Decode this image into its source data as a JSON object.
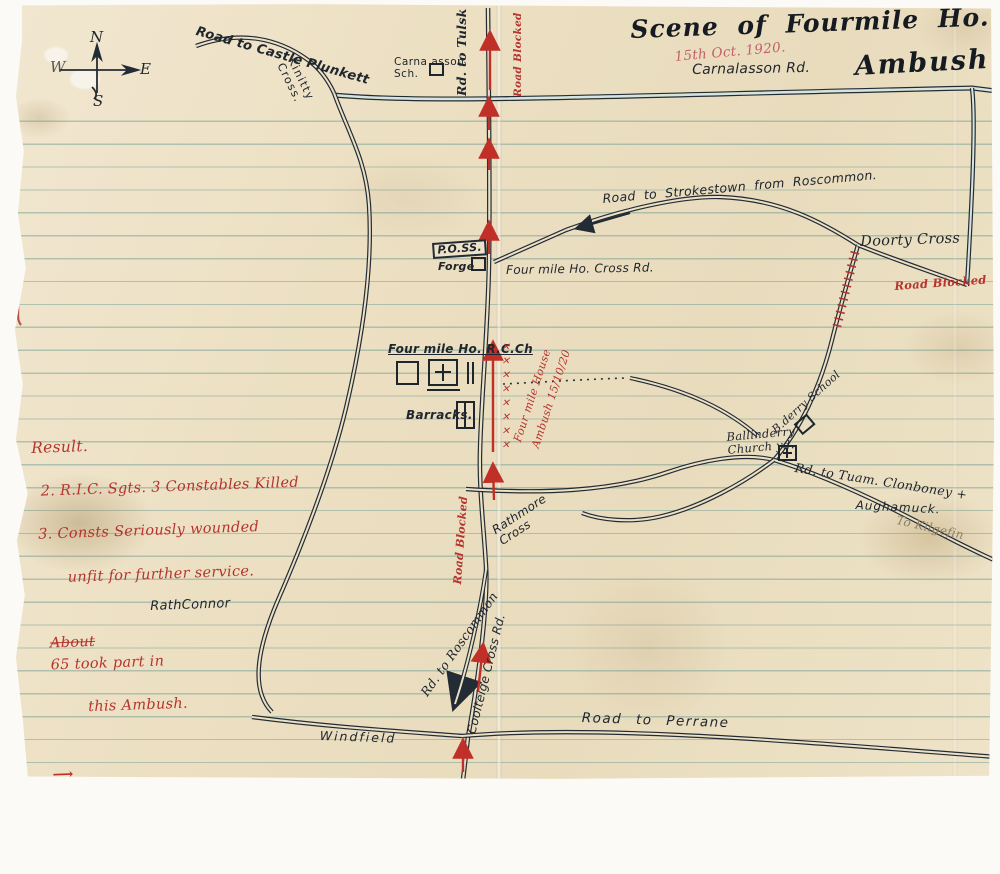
{
  "document": {
    "title_line1": "Scene of Fourmile Ho.",
    "title_line2": "Ambush.",
    "date": "15th Oct. 1920."
  },
  "compass": {
    "north": "N",
    "east": "E",
    "south": "S",
    "west": "W"
  },
  "roads": {
    "castle_plunkett": "Road to Castle Plunkett",
    "kinitty_cross": "Kinitty\nCross.",
    "carnasson_school": "Carna asson\nSch.",
    "rd_to_tulsk": "Rd. to Tulsk",
    "carnalasson_rd": "Carnalasson Rd.",
    "strokestown": "Road to  Strokestown from Roscommon.",
    "doorty_cross": "Doorty Cross",
    "fourmile_cross_rd": "Four mile Ho. Cross Rd.",
    "rathmore_cross": "Rathmore\nCross",
    "rd_to_tuam": "Rd. to Tuam. Clonboney +",
    "aughamuck": "Aughamuck.",
    "to_kilgefin": "To Kilgefin",
    "rathconnor": "RathConnor",
    "rd_to_roscommon": "Rd. to Roscommon",
    "coolteige": "Coolteige Cross Rd.",
    "windfield": "Windfield",
    "road_to_perrane": "Road to Perrane"
  },
  "places": {
    "post_office": "P.O.SS.",
    "forge": "Forge",
    "rc_church": "Four mile Ho. R.C.Ch",
    "barracks": "Barracks.",
    "bderry_school": "B.derry School",
    "ballinderry_churchyard": "Ballinderry\nChurch yd."
  },
  "red_annotations": {
    "road_blocked_top": "Road Blocked",
    "road_blocked_doorty": "Road Blocked",
    "road_blocked_south": "Road Blocked",
    "ambush_line1": "Four mile House",
    "ambush_line2": "Ambush 15/10/20",
    "x_marks": "✕✕✕✕✕✕✕✕"
  },
  "result_note": {
    "heading": "Result.",
    "line1": "2. R.I.C. Sgts. 3 Constables Killed",
    "line2": "3. Consts Seriously wounded",
    "line3": "unfit for further service.",
    "line4_struck": "About",
    "line4": "65 took part in",
    "line5": "this Ambush.",
    "line6": "indicate the direction the",
    "line7": "Crossley Travelled."
  },
  "icons": {
    "direction_arrow": "⟶"
  },
  "colors": {
    "ink": "#232c35",
    "red_ink": "#b5352e",
    "paper": "#ece1c6",
    "rule_line": "#6e9b91"
  }
}
